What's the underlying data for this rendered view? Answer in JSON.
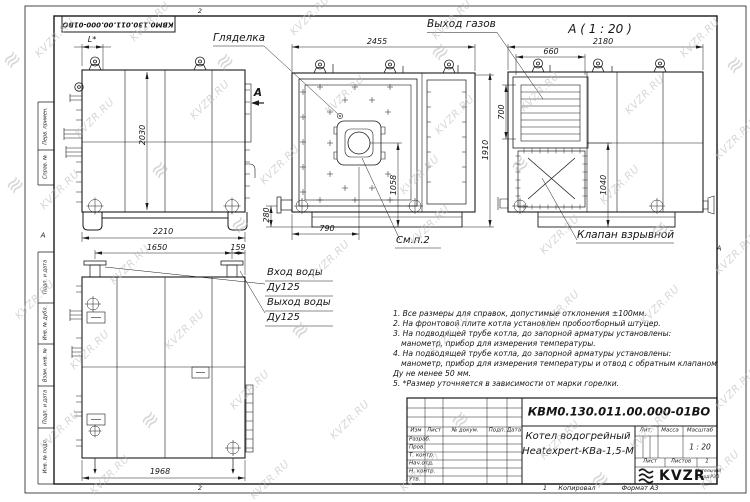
{
  "watermark": {
    "text": "KVZR.RU"
  },
  "frame": {
    "stamp": "КВМ0.130.011.00.000-01ВО",
    "zone_top": "2",
    "zone_bottom": "2",
    "fold_left": "А",
    "fold_right": "А",
    "cells": [
      "Перв. примен.",
      "Справ. №",
      "Подп. и дата",
      "Инв. № дубл.",
      "Взам. инв. №",
      "Подп. и дата",
      "Инв. № подл."
    ]
  },
  "front_view": {
    "dim_l": "L*",
    "dim_height": "2030",
    "dim_width": "2210",
    "section_mark": "А"
  },
  "face_view": {
    "peephole_label": "Гляделка",
    "gas_label": "Выход газов",
    "dim_width": "2455",
    "dim_height": "1910",
    "dim_burner_v": "1058",
    "dim_burner_x": "790",
    "dim_pipe": "280",
    "see_note": "См.п.2"
  },
  "section_view": {
    "title": "А ( 1 : 20 )",
    "dim_width": "2180",
    "dim_grille_w": "660",
    "dim_grille_h": "700",
    "dim_valve_v": "1040",
    "valve_label": "Клапан взрывной"
  },
  "rear_view": {
    "dim_nozzles": "1650",
    "dim_edge": "159",
    "dim_width": "1968",
    "inlet_label": "Вход воды",
    "inlet_dn": "Ду125",
    "outlet_label": "Выход воды",
    "outlet_dn": "Ду125"
  },
  "notes": {
    "lines": [
      "1. Все размеры для справок, допустимые отклонения ±100мм.",
      "2. На фронтовой плите котла установлен пробоотборный штуцер.",
      "3. На подводящей трубе котла, до запорной арматуры установлены:",
      "манометр, прибор для измерения температуры.",
      "4. На подводящей трубе котла, до запорной арматуры установлены:",
      "манометр, прибор для измерения температуры и отвод с обратным клапаном",
      "Ду не менее 50 мм.",
      "5. *Размер уточняется в зависимости от марки горелки."
    ]
  },
  "title_block": {
    "doc_number": "КВМ0.130.011.00.000-01ВО",
    "product_line1": "Котел водогрейный",
    "product_line2": "Heatexpert-КВа-1,5-М",
    "hdr": {
      "izm": "Изм",
      "list": "Лист",
      "doc": "№ докум.",
      "podp": "Подп.",
      "data": "Дата"
    },
    "rows": [
      "Разраб.",
      "Пров.",
      "Т. контр.",
      "Нач.отд.",
      "Н. контр.",
      "Утв."
    ],
    "lit": "Лит.",
    "mass": "Масса",
    "scale": "Масштаб",
    "scale_value": "1 : 20",
    "sheet": "Лист",
    "sheets": "Листов",
    "sheets_value": "1",
    "logo": "KVZR",
    "logo_sub1": "Котельный",
    "logo_sub2": "завод РЭП",
    "sheet_no": "1",
    "copied": "Копировал",
    "format": "Формат А3"
  }
}
